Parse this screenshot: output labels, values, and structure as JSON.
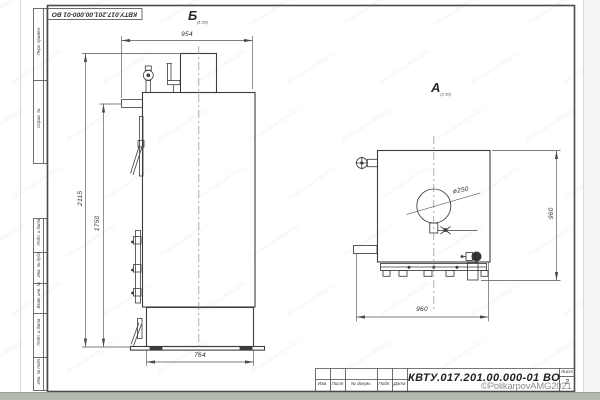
{
  "sheet": {
    "designation_rotated": "КВТУ.017.201.00.000-01 ВО",
    "title_block": {
      "designation": "КВТУ.017.201.00.000-01  ВО",
      "columns": [
        "Изм.",
        "Лист",
        "№ докум.",
        "Подп.",
        "Дата"
      ],
      "sheet_label": "Лист",
      "sheet_number": "2"
    },
    "side_labels": {
      "perv_primen": "Перв. примен.",
      "sprav_no": "Справ. №",
      "podp_data_1": "Подп. и дата",
      "inv_dubl": "Инв. № дубл.",
      "vzam_inv": "Взам. инв. №",
      "podp_data_2": "Подп. и дата",
      "inv_podl": "Инв. № подл."
    }
  },
  "views": {
    "left": {
      "label": "Б",
      "sub": "(1:10)"
    },
    "right": {
      "label": "А",
      "sub": "(1:10)"
    }
  },
  "dimensions": {
    "top_width": "954",
    "total_height": "2115",
    "body_height": "1750",
    "base_width": "764",
    "rear_width": "960",
    "rear_height": "960",
    "flue_diameter": "ø250"
  },
  "watermark": {
    "credit": "©PolikarpovAMG2021",
    "tile": "©PolikarpovAMG2021"
  }
}
